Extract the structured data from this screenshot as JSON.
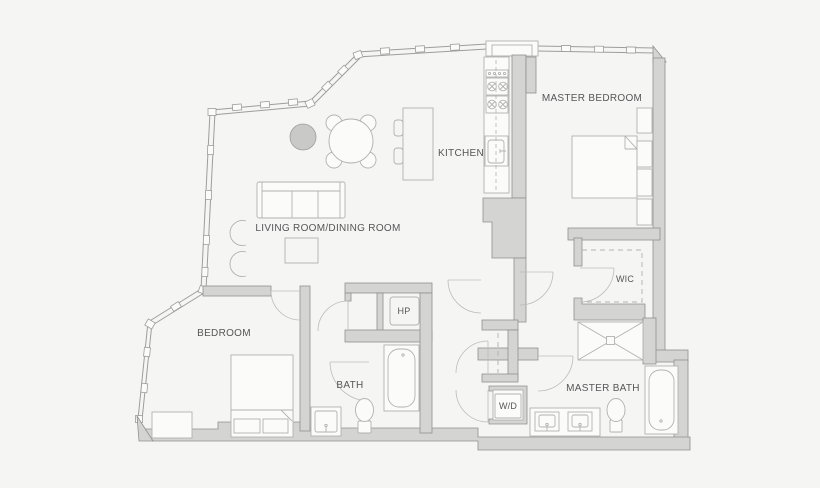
{
  "colors": {
    "background": "#f5f5f4",
    "wall_fill": "#d4d4d2",
    "wall_stroke": "#90908e",
    "window_line": "#9d9d9b",
    "furniture_line": "#b2b2b0",
    "door_line": "#bcbcba",
    "fixture_fill": "#fbfbfa",
    "accent_circle": "#c9c9c7",
    "text": "#565658"
  },
  "rooms": [
    {
      "id": "master-bedroom",
      "label": "MASTER BEDROOM"
    },
    {
      "id": "kitchen",
      "label": "KITCHEN"
    },
    {
      "id": "living-dining",
      "label": "LIVING ROOM/DINING ROOM"
    },
    {
      "id": "bedroom",
      "label": "BEDROOM"
    },
    {
      "id": "bath",
      "label": "BATH"
    },
    {
      "id": "master-bath",
      "label": "MASTER BATH"
    },
    {
      "id": "walk-in-closet",
      "label": "WIC"
    },
    {
      "id": "washer-dryer",
      "label": "W/D"
    },
    {
      "id": "heat-pump",
      "label": "HP"
    }
  ]
}
